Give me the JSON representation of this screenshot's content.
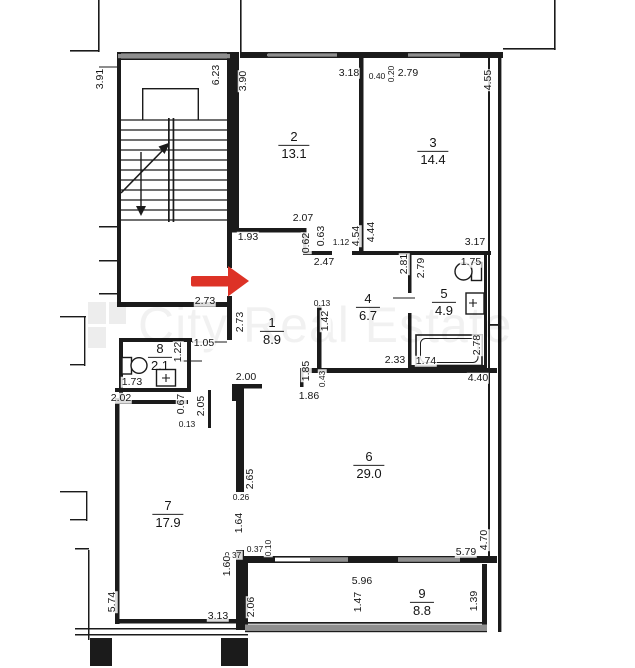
{
  "watermark": {
    "text": "City Real Estate"
  },
  "colors": {
    "wall": "#1b1b1b",
    "window": "#8f8f8f",
    "arrow": "#dd3226",
    "watermark_text": "rgba(0,0,0,0.055)",
    "watermark_block": "rgba(0,0,0,0.07)"
  },
  "rooms": [
    {
      "number": "1",
      "area": "8.9",
      "x": 272,
      "y": 331
    },
    {
      "number": "2",
      "area": "13.1",
      "x": 294,
      "y": 145
    },
    {
      "number": "3",
      "area": "14.4",
      "x": 433,
      "y": 151
    },
    {
      "number": "4",
      "area": "6.7",
      "x": 368,
      "y": 307
    },
    {
      "number": "5",
      "area": "4.9",
      "x": 444,
      "y": 302
    },
    {
      "number": "6",
      "area": "29.0",
      "x": 369,
      "y": 465
    },
    {
      "number": "7",
      "area": "17.9",
      "x": 168,
      "y": 514
    },
    {
      "number": "8",
      "area": "2.1",
      "x": 160,
      "y": 357
    },
    {
      "number": "9",
      "area": "8.8",
      "x": 422,
      "y": 602
    }
  ],
  "dimensions": [
    {
      "t": "3.91",
      "x": 100,
      "y": 79,
      "r": true
    },
    {
      "t": "6.23",
      "x": 216,
      "y": 75,
      "r": true
    },
    {
      "t": "3.90",
      "x": 243,
      "y": 81,
      "r": true
    },
    {
      "t": "3.18",
      "x": 349,
      "y": 73
    },
    {
      "t": "0.40",
      "x": 377,
      "y": 76,
      "s": true
    },
    {
      "t": "0.20",
      "x": 391,
      "y": 74,
      "r": true,
      "s": true
    },
    {
      "t": "2.79",
      "x": 408,
      "y": 73
    },
    {
      "t": "4.55",
      "x": 488,
      "y": 80,
      "r": true
    },
    {
      "t": "2.07",
      "x": 303,
      "y": 218
    },
    {
      "t": "1.93",
      "x": 248,
      "y": 237
    },
    {
      "t": "0.62",
      "x": 306,
      "y": 243,
      "r": true
    },
    {
      "t": "0.63",
      "x": 321,
      "y": 236,
      "r": true
    },
    {
      "t": "1.12",
      "x": 341,
      "y": 242,
      "s": true
    },
    {
      "t": "4.54",
      "x": 356,
      "y": 236,
      "r": true
    },
    {
      "t": "4.44",
      "x": 371,
      "y": 232,
      "r": true
    },
    {
      "t": "2.47",
      "x": 324,
      "y": 262
    },
    {
      "t": "3.17",
      "x": 475,
      "y": 242
    },
    {
      "t": "2.81",
      "x": 404,
      "y": 264,
      "r": true
    },
    {
      "t": "2.79",
      "x": 421,
      "y": 268,
      "r": true
    },
    {
      "t": "1.75",
      "x": 471,
      "y": 262
    },
    {
      "t": "2.73",
      "x": 205,
      "y": 301
    },
    {
      "t": "2.73",
      "x": 240,
      "y": 322,
      "r": true
    },
    {
      "t": "1.05",
      "x": 204,
      "y": 343
    },
    {
      "t": "1.22",
      "x": 178,
      "y": 352,
      "r": true
    },
    {
      "t": "1.73",
      "x": 132,
      "y": 382
    },
    {
      "t": "2.02",
      "x": 121,
      "y": 398
    },
    {
      "t": "0.67",
      "x": 181,
      "y": 404,
      "r": true
    },
    {
      "t": "2.05",
      "x": 201,
      "y": 406,
      "r": true
    },
    {
      "t": "0.13",
      "x": 187,
      "y": 424,
      "s": true
    },
    {
      "t": "0.13",
      "x": 322,
      "y": 303,
      "s": true
    },
    {
      "t": "1.42",
      "x": 325,
      "y": 321,
      "r": true
    },
    {
      "t": "2.33",
      "x": 395,
      "y": 360
    },
    {
      "t": "1.74",
      "x": 426,
      "y": 361
    },
    {
      "t": "2.78",
      "x": 477,
      "y": 345,
      "r": true
    },
    {
      "t": "1.85",
      "x": 306,
      "y": 371,
      "r": true
    },
    {
      "t": "0.43",
      "x": 322,
      "y": 379,
      "r": true,
      "s": true
    },
    {
      "t": "1.86",
      "x": 309,
      "y": 396
    },
    {
      "t": "2.00",
      "x": 246,
      "y": 377
    },
    {
      "t": "4.40",
      "x": 478,
      "y": 378
    },
    {
      "t": "2.65",
      "x": 250,
      "y": 479,
      "r": true
    },
    {
      "t": "0.26",
      "x": 241,
      "y": 497,
      "s": true
    },
    {
      "t": "1.64",
      "x": 239,
      "y": 523,
      "r": true
    },
    {
      "t": "0.37",
      "x": 233,
      "y": 555,
      "s": true
    },
    {
      "t": "0.37",
      "x": 255,
      "y": 549,
      "s": true
    },
    {
      "t": "0.10",
      "x": 268,
      "y": 548,
      "r": true,
      "s": true
    },
    {
      "t": "1.60",
      "x": 227,
      "y": 566,
      "r": true
    },
    {
      "t": "5.74",
      "x": 112,
      "y": 602,
      "r": true
    },
    {
      "t": "3.13",
      "x": 218,
      "y": 616
    },
    {
      "t": "2.06",
      "x": 251,
      "y": 607,
      "r": true
    },
    {
      "t": "5.96",
      "x": 362,
      "y": 581
    },
    {
      "t": "1.47",
      "x": 358,
      "y": 602,
      "r": true
    },
    {
      "t": "1.39",
      "x": 474,
      "y": 601,
      "r": true
    },
    {
      "t": "5.79",
      "x": 466,
      "y": 552
    },
    {
      "t": "4.70",
      "x": 484,
      "y": 540,
      "r": true
    }
  ]
}
